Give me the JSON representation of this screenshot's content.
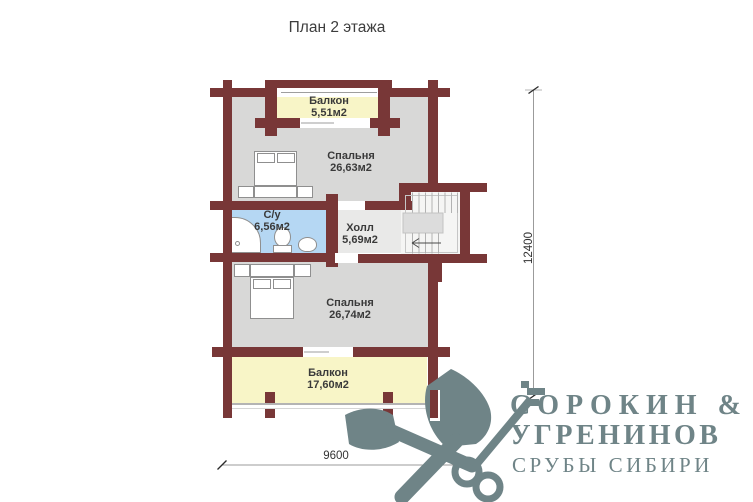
{
  "title": "План 2 этажа",
  "rooms": {
    "balcony_top": {
      "name": "Балкон",
      "area": "5,51м2"
    },
    "bedroom_top": {
      "name": "Спальня",
      "area": "26,63м2"
    },
    "bathroom": {
      "name": "С/у",
      "area": "6,56м2"
    },
    "hall": {
      "name": "Холл",
      "area": "5,69м2"
    },
    "bedroom_bottom": {
      "name": "Спальня",
      "area": "26,74м2"
    },
    "balcony_bottom": {
      "name": "Балкон",
      "area": "17,60м2"
    }
  },
  "dimensions": {
    "height_mm": "12400",
    "width_mm": "9600"
  },
  "logo": {
    "line1": "СОРОКИН &",
    "line2": "УГРЕНИНОВ",
    "line3": "СРУБЫ СИБИРИ",
    "icon": "crossed-axe-key-icon"
  },
  "colors": {
    "wall": "#783737",
    "bedroom_floor": "#d8d8d7",
    "balcony_floor": "#f8f5c7",
    "bathroom_floor": "#b5d7f3",
    "hall_floor": "#e9e9e8",
    "logo": "#6f8487"
  }
}
